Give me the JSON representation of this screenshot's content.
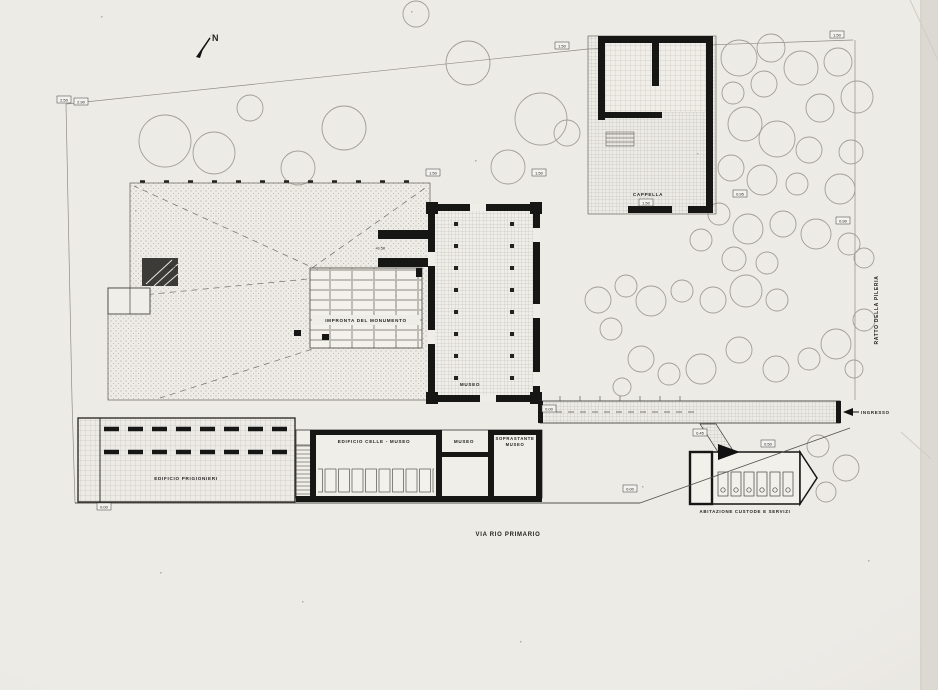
{
  "drawing": {
    "type": "architectural site plan (scanned, black ink on paper)",
    "compass_label": "N"
  },
  "colors": {
    "paper": "#edebe6",
    "ink": "#161614",
    "faint_line": "#8f8b84",
    "tree_outline": "#a29e96"
  },
  "labels": {
    "cappella": "CAPPELLA",
    "impronta_monumento": "IMPRONTA DEL MONUMENTO",
    "museo_building": "MUSEO",
    "edificio_celle": "EDIFICIO CELLE - MUSEO",
    "museo_room": "MUSEO",
    "soprastante_line1": "SOPRASTANTE",
    "soprastante_line2": "MUSEO",
    "edificio_prigionieri": "EDIFICIO PRIGIONIERI",
    "abitazione_custode": "ABITAZIONE CUSTODE E SERVIZI",
    "ingresso": "INGRESSO",
    "via_rio_primario": "VIA RIO PRIMARIO",
    "ratto_della_pileria": "RATTO DELLA PILERIA",
    "north": "N"
  },
  "markers": [
    {
      "x": 64,
      "y": 100,
      "v": "2.50"
    },
    {
      "x": 81,
      "y": 102,
      "v": "2.90"
    },
    {
      "x": 562,
      "y": 46,
      "v": "1.50"
    },
    {
      "x": 837,
      "y": 35,
      "v": "1.50"
    },
    {
      "x": 433,
      "y": 173,
      "v": "1.50"
    },
    {
      "x": 539,
      "y": 173,
      "v": "1.50"
    },
    {
      "x": 740,
      "y": 194,
      "v": "0.95"
    },
    {
      "x": 843,
      "y": 221,
      "v": "0.90"
    },
    {
      "x": 549,
      "y": 409,
      "v": "0.00"
    },
    {
      "x": 700,
      "y": 433,
      "v": "0.45"
    },
    {
      "x": 768,
      "y": 444,
      "v": "0.50"
    },
    {
      "x": 630,
      "y": 489,
      "v": "0.00"
    },
    {
      "x": 646,
      "y": 203,
      "v": "1.50"
    },
    {
      "x": 104,
      "y": 507,
      "v": "0.00"
    },
    {
      "x": 380,
      "y": 248,
      "v": "+0.50",
      "box": false
    },
    {
      "x": 172,
      "y": 267,
      "v": "+1.20",
      "box": false
    }
  ],
  "trees": [
    [
      165,
      141,
      26
    ],
    [
      214,
      153,
      21
    ],
    [
      250,
      108,
      13
    ],
    [
      298,
      168,
      17
    ],
    [
      344,
      128,
      22
    ],
    [
      416,
      14,
      13
    ],
    [
      468,
      63,
      22
    ],
    [
      508,
      167,
      17
    ],
    [
      541,
      119,
      26
    ],
    [
      567,
      133,
      13
    ],
    [
      739,
      58,
      18
    ],
    [
      771,
      48,
      14
    ],
    [
      801,
      68,
      17
    ],
    [
      764,
      84,
      13
    ],
    [
      733,
      93,
      11
    ],
    [
      838,
      62,
      14
    ],
    [
      857,
      97,
      16
    ],
    [
      820,
      108,
      14
    ],
    [
      745,
      124,
      17
    ],
    [
      777,
      139,
      18
    ],
    [
      809,
      150,
      13
    ],
    [
      851,
      152,
      12
    ],
    [
      731,
      168,
      13
    ],
    [
      762,
      180,
      15
    ],
    [
      797,
      184,
      11
    ],
    [
      840,
      189,
      15
    ],
    [
      719,
      214,
      11
    ],
    [
      748,
      229,
      15
    ],
    [
      701,
      240,
      11
    ],
    [
      783,
      224,
      13
    ],
    [
      816,
      234,
      15
    ],
    [
      849,
      244,
      11
    ],
    [
      864,
      258,
      10
    ],
    [
      734,
      259,
      12
    ],
    [
      767,
      263,
      11
    ],
    [
      598,
      300,
      13
    ],
    [
      626,
      286,
      11
    ],
    [
      651,
      301,
      15
    ],
    [
      611,
      329,
      11
    ],
    [
      682,
      291,
      11
    ],
    [
      713,
      300,
      13
    ],
    [
      746,
      291,
      16
    ],
    [
      777,
      300,
      11
    ],
    [
      864,
      320,
      11
    ],
    [
      641,
      359,
      13
    ],
    [
      669,
      374,
      11
    ],
    [
      701,
      369,
      15
    ],
    [
      739,
      350,
      13
    ],
    [
      776,
      369,
      13
    ],
    [
      809,
      359,
      11
    ],
    [
      836,
      344,
      15
    ],
    [
      854,
      369,
      9
    ],
    [
      622,
      387,
      9
    ],
    [
      818,
      446,
      11
    ],
    [
      846,
      468,
      13
    ],
    [
      826,
      492,
      10
    ]
  ]
}
